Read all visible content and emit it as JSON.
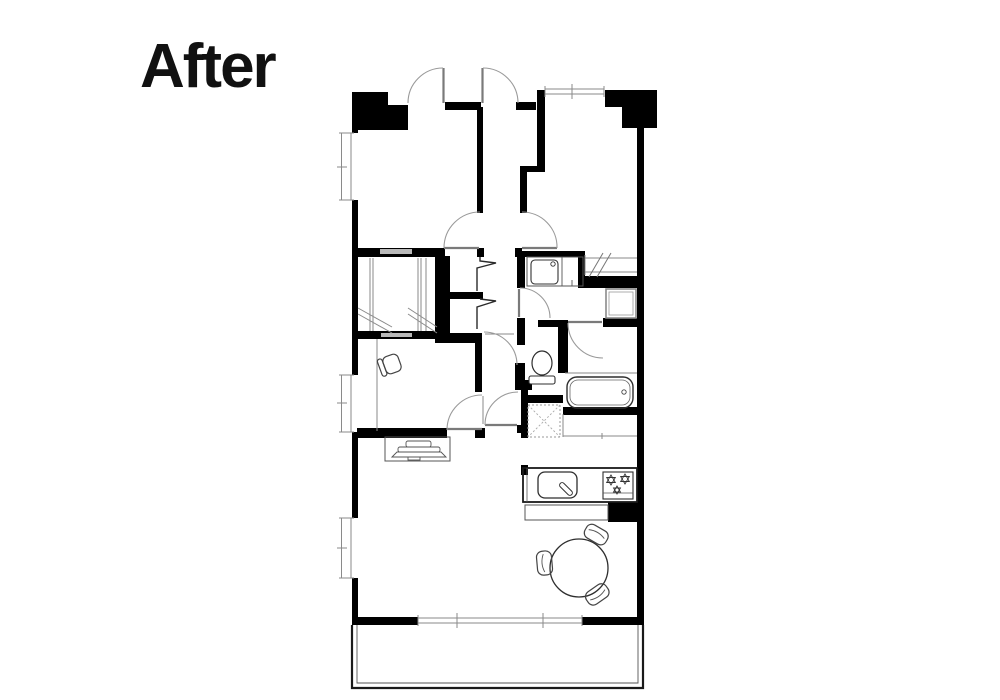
{
  "title": "After",
  "colors": {
    "wall": "#000000",
    "thin": "#8a8a8a",
    "leaf": "#7a7a7a",
    "arc": "#9a9a9a",
    "gap": "#b9b9b9",
    "zigzag": "#2b2b2b",
    "background": "#ffffff"
  },
  "plan": {
    "walls": [
      [
        352,
        92,
        36,
        38
      ],
      [
        388,
        105,
        20,
        25
      ],
      [
        445,
        102,
        36,
        8
      ],
      [
        516,
        102,
        20,
        8
      ],
      [
        537,
        90,
        8,
        78
      ],
      [
        605,
        90,
        17,
        17
      ],
      [
        622,
        90,
        35,
        38
      ],
      [
        637,
        128,
        7,
        497
      ],
      [
        352,
        92,
        6,
        41
      ],
      [
        352,
        200,
        6,
        175
      ],
      [
        352,
        432,
        6,
        86
      ],
      [
        352,
        578,
        6,
        47
      ],
      [
        352,
        617,
        66,
        8
      ],
      [
        582,
        617,
        62,
        8
      ],
      [
        357,
        248,
        88,
        9
      ],
      [
        477,
        248,
        7,
        9
      ],
      [
        477,
        107,
        6,
        106
      ],
      [
        520,
        166,
        25,
        6
      ],
      [
        520,
        172,
        7,
        41
      ],
      [
        515,
        248,
        7,
        9
      ],
      [
        522,
        251,
        63,
        6
      ],
      [
        517,
        257,
        8,
        31
      ],
      [
        578,
        255,
        7,
        33
      ],
      [
        585,
        276,
        52,
        12
      ],
      [
        517,
        318,
        8,
        27
      ],
      [
        538,
        320,
        24,
        7
      ],
      [
        603,
        318,
        34,
        9
      ],
      [
        558,
        320,
        10,
        53
      ],
      [
        515,
        363,
        10,
        17
      ],
      [
        515,
        380,
        17,
        10
      ],
      [
        521,
        390,
        7,
        48
      ],
      [
        528,
        395,
        35,
        8
      ],
      [
        563,
        407,
        74,
        8
      ],
      [
        475,
        333,
        7,
        59
      ],
      [
        475,
        428,
        10,
        10
      ],
      [
        517,
        425,
        8,
        8
      ],
      [
        435,
        256,
        15,
        87
      ],
      [
        450,
        333,
        28,
        10
      ],
      [
        448,
        292,
        35,
        7
      ],
      [
        357,
        331,
        90,
        8
      ],
      [
        357,
        428,
        90,
        10
      ],
      [
        521,
        465,
        7,
        10
      ],
      [
        608,
        502,
        32,
        20
      ]
    ],
    "gray_gaps": [
      [
        380,
        249,
        32,
        5
      ],
      [
        381,
        333,
        31,
        4
      ]
    ],
    "thin_lines": [
      [
        565,
        373,
        637,
        373
      ],
      [
        563,
        414,
        563,
        437
      ],
      [
        563,
        436,
        637,
        436
      ],
      [
        602,
        433,
        602,
        439
      ],
      [
        485,
        334,
        514,
        334
      ],
      [
        483,
        396,
        483,
        424
      ],
      [
        377,
        339,
        377,
        431
      ],
      [
        370,
        258,
        370,
        331
      ],
      [
        373,
        258,
        373,
        331
      ],
      [
        418,
        258,
        418,
        331
      ],
      [
        421,
        258,
        421,
        331
      ],
      [
        426,
        258,
        426,
        331
      ],
      [
        358,
        308,
        392,
        327
      ],
      [
        358,
        314,
        392,
        333
      ],
      [
        408,
        308,
        437,
        327
      ],
      [
        408,
        314,
        437,
        333
      ]
    ],
    "door_leaves": [
      [
        443.5,
        68,
        443.5,
        103
      ],
      [
        482.5,
        68,
        482.5,
        103
      ],
      [
        444,
        248,
        479,
        248
      ],
      [
        522,
        248,
        557,
        248
      ],
      [
        519,
        289,
        519,
        317
      ],
      [
        447,
        429,
        482,
        429
      ],
      [
        485,
        425,
        517,
        425
      ],
      [
        568,
        322,
        602,
        322
      ]
    ],
    "door_arcs": [
      "M408,103 A35,35 0 0 1 443,68",
      "M483,68 A35,35 0 0 1 518,103",
      "M480,212 A36,36 0 0 0 444,248",
      "M522,212 A35,35 0 0 1 557,248",
      "M520,288 A30,30 0 0 1 550,318",
      "M484,332 A33,33 0 0 1 517,365",
      "M482,395 A35,35 0 0 0 447,430",
      "M485,425 A33,33 0 0 1 518,392",
      "M568,323 A35,35 0 0 0 603,358"
    ],
    "zigzag_doors": [
      [
        480,
        257,
        480,
        261,
        496,
        263,
        477,
        268,
        477,
        291
      ],
      [
        480,
        299,
        496,
        301,
        477,
        307,
        477,
        329
      ]
    ],
    "windows": [
      {
        "o": "v",
        "x": 340,
        "y": 133,
        "len": 67,
        "ticks": [
          167
        ]
      },
      {
        "o": "v",
        "x": 340,
        "y": 375,
        "len": 57,
        "ticks": [
          403
        ]
      },
      {
        "o": "v",
        "x": 340,
        "y": 518,
        "len": 60,
        "ticks": [
          548
        ]
      },
      {
        "o": "h",
        "x": 545,
        "y": 88,
        "len": 59,
        "ticks": [
          572
        ]
      },
      {
        "o": "h",
        "x": 418,
        "y": 617,
        "len": 164,
        "ticks": [
          457,
          543
        ]
      }
    ],
    "fixtures": [
      {
        "name": "bathtub",
        "items": [
          {
            "t": "rect",
            "x": 567,
            "y": 377,
            "w": 66,
            "h": 31,
            "rx": 10,
            "sw": 1.4,
            "st": "#2e2e2e"
          },
          {
            "t": "rect",
            "x": 570,
            "y": 380,
            "w": 60,
            "h": 25,
            "rx": 8,
            "sw": 0.8,
            "st": "#666666"
          },
          {
            "t": "circle",
            "cx": 624,
            "cy": 392,
            "r": 2.2,
            "sw": 0.9,
            "st": "#444444"
          }
        ]
      },
      {
        "name": "toilet",
        "items": [
          {
            "t": "ellipse",
            "cx": 542,
            "cy": 363,
            "rx": 10,
            "ry": 12,
            "sw": 1.2,
            "st": "#2e2e2e"
          },
          {
            "t": "rect",
            "x": 529,
            "y": 376,
            "w": 26,
            "h": 8,
            "rx": 2,
            "sw": 1.1,
            "st": "#2e2e2e",
            "f": "#ffffff"
          }
        ]
      },
      {
        "name": "vanity-basin",
        "items": [
          {
            "t": "rect",
            "x": 527,
            "y": 257,
            "w": 56,
            "h": 29,
            "sw": 1,
            "st": "#555555"
          },
          {
            "t": "line",
            "x1": 562,
            "y1": 257,
            "x2": 562,
            "y2": 286,
            "sw": 0.9,
            "st": "#555555"
          },
          {
            "t": "rect",
            "x": 531,
            "y": 260,
            "w": 27,
            "h": 24,
            "rx": 4,
            "sw": 1.1,
            "st": "#333333"
          },
          {
            "t": "circle",
            "cx": 553,
            "cy": 264,
            "r": 2.2,
            "sw": 0.9,
            "st": "#333333"
          },
          {
            "t": "line",
            "x1": 572,
            "y1": 280,
            "x2": 572,
            "y2": 286,
            "sw": 0.9,
            "st": "#555555"
          }
        ]
      },
      {
        "name": "pipe-space-box",
        "items": [
          {
            "t": "rect",
            "x": 606,
            "y": 289,
            "w": 30,
            "h": 29,
            "sw": 1.6,
            "st": "#8a8a8a"
          },
          {
            "t": "rect",
            "x": 609,
            "y": 292,
            "w": 24,
            "h": 23,
            "sw": 0.8,
            "st": "#9a9a9a"
          }
        ]
      },
      {
        "name": "interior-window-slashed",
        "items": [
          {
            "t": "line",
            "x1": 585,
            "y1": 258,
            "x2": 637,
            "y2": 258,
            "sw": 1,
            "st": "#8a8a8a"
          },
          {
            "t": "line",
            "x1": 585,
            "y1": 272,
            "x2": 637,
            "y2": 272,
            "sw": 1,
            "st": "#8a8a8a"
          },
          {
            "t": "line",
            "x1": 585,
            "y1": 255,
            "x2": 585,
            "y2": 275,
            "sw": 1,
            "st": "#8a8a8a"
          },
          {
            "t": "line",
            "x1": 589,
            "y1": 277,
            "x2": 603,
            "y2": 253,
            "sw": 1,
            "st": "#777777"
          },
          {
            "t": "line",
            "x1": 597,
            "y1": 277,
            "x2": 611,
            "y2": 253,
            "sw": 1,
            "st": "#777777"
          }
        ]
      },
      {
        "name": "washing-machine-space",
        "items": [
          {
            "t": "rect",
            "x": 528,
            "y": 405,
            "w": 32,
            "h": 32,
            "sw": 1,
            "st": "#999999",
            "dash": 1
          },
          {
            "t": "line",
            "x1": 528,
            "y1": 405,
            "x2": 560,
            "y2": 437,
            "sw": 0.9,
            "st": "#aaaaaa",
            "dash": 1
          },
          {
            "t": "line",
            "x1": 560,
            "y1": 405,
            "x2": 528,
            "y2": 437,
            "sw": 0.9,
            "st": "#aaaaaa",
            "dash": 1
          }
        ]
      },
      {
        "name": "kitchen-counter",
        "items": [
          {
            "t": "rect",
            "x": 523,
            "y": 468,
            "w": 114,
            "h": 34,
            "sw": 1.8,
            "st": "#1a1a1a"
          },
          {
            "t": "line",
            "x1": 527,
            "y1": 468,
            "x2": 527,
            "y2": 502,
            "sw": 0.8,
            "st": "#555555"
          }
        ]
      },
      {
        "name": "kitchen-sink",
        "items": [
          {
            "t": "rect",
            "x": 538,
            "y": 472,
            "w": 39,
            "h": 26,
            "rx": 7,
            "sw": 1.3,
            "st": "#2e2e2e"
          },
          {
            "t": "g",
            "tf": "translate(566,489) rotate(-45)",
            "items": [
              {
                "t": "rect",
                "x": -2.5,
                "y": -8,
                "w": 5,
                "h": 16,
                "rx": 2.5,
                "sw": 1,
                "st": "#333333",
                "f": "#ffffff"
              }
            ]
          }
        ]
      },
      {
        "name": "gas-stove",
        "items": [
          {
            "t": "rect",
            "x": 603,
            "y": 472,
            "w": 30,
            "h": 27,
            "sw": 1.1,
            "st": "#2e2e2e"
          },
          {
            "t": "line",
            "x1": 603,
            "y1": 493,
            "x2": 633,
            "y2": 493,
            "sw": 0.8,
            "st": "#555555"
          },
          {
            "t": "hex",
            "cx": 611,
            "cy": 480,
            "r": 5
          },
          {
            "t": "hex",
            "cx": 625,
            "cy": 479,
            "r": 5
          },
          {
            "t": "hex",
            "cx": 617,
            "cy": 490,
            "r": 4
          }
        ]
      },
      {
        "name": "counter-front",
        "items": [
          {
            "t": "rect",
            "x": 525,
            "y": 505,
            "w": 83,
            "h": 15,
            "sw": 1,
            "st": "#555555"
          }
        ]
      },
      {
        "name": "tv-board",
        "items": [
          {
            "t": "rect",
            "x": 385,
            "y": 437,
            "w": 65,
            "h": 24,
            "sw": 1,
            "st": "#555555"
          },
          {
            "t": "rect",
            "x": 406,
            "y": 441,
            "w": 25,
            "h": 6,
            "rx": 2,
            "sw": 0.9,
            "st": "#555555"
          },
          {
            "t": "rect",
            "x": 398,
            "y": 447,
            "w": 42,
            "h": 5,
            "rx": 2,
            "sw": 0.9,
            "st": "#555555"
          },
          {
            "t": "path",
            "d": "M392,457 L397,452 L441,452 L446,457 Z",
            "sw": 0.9,
            "st": "#555555"
          },
          {
            "t": "rect",
            "x": 408,
            "y": 457,
            "w": 12,
            "h": 3,
            "sw": 0.9,
            "st": "#555555"
          }
        ]
      },
      {
        "name": "desk-chair",
        "items": [
          {
            "t": "g",
            "tf": "translate(392,364) rotate(-20)",
            "items": [
              {
                "t": "rect",
                "x": -8,
                "y": -9,
                "w": 16,
                "h": 18,
                "rx": 5,
                "sw": 1.2,
                "st": "#444444"
              },
              {
                "t": "rect",
                "x": -13,
                "y": -9,
                "w": 5,
                "h": 18,
                "rx": 2.5,
                "sw": 1.2,
                "st": "#444444"
              }
            ]
          }
        ]
      },
      {
        "name": "dining-table",
        "items": [
          {
            "t": "circle",
            "cx": 579,
            "cy": 568,
            "r": 29,
            "sw": 1.3,
            "st": "#2e2e2e"
          }
        ]
      },
      {
        "name": "dining-chair",
        "items": [
          {
            "t": "g",
            "tf": "translate(596,535) rotate(30)",
            "items": [
              {
                "t": "rect",
                "x": -12,
                "y": -8,
                "w": 24,
                "h": 15,
                "rx": 6,
                "sw": 1.2,
                "st": "#444444"
              },
              {
                "t": "path",
                "d": "M-9,-1 Q0,-5 9,-1",
                "sw": 0.9,
                "st": "#555555"
              }
            ]
          }
        ]
      },
      {
        "name": "dining-chair",
        "items": [
          {
            "t": "g",
            "tf": "translate(545,563) rotate(-95)",
            "items": [
              {
                "t": "rect",
                "x": -12,
                "y": -8,
                "w": 24,
                "h": 15,
                "rx": 6,
                "sw": 1.2,
                "st": "#444444"
              },
              {
                "t": "path",
                "d": "M-9,-1 Q0,-5 9,-1",
                "sw": 0.9,
                "st": "#555555"
              }
            ]
          }
        ]
      },
      {
        "name": "dining-chair",
        "items": [
          {
            "t": "g",
            "tf": "translate(597,594) rotate(145)",
            "items": [
              {
                "t": "rect",
                "x": -12,
                "y": -8,
                "w": 24,
                "h": 15,
                "rx": 6,
                "sw": 1.2,
                "st": "#444444"
              },
              {
                "t": "path",
                "d": "M-9,-1 Q0,-5 9,-1",
                "sw": 0.9,
                "st": "#555555"
              }
            ]
          }
        ]
      },
      {
        "name": "balcony",
        "items": [
          {
            "t": "path",
            "d": "M352,625 L352,688 L643,688 L643,625",
            "sw": 2.2,
            "st": "#1a1a1a"
          },
          {
            "t": "path",
            "d": "M357,625 L357,683 L638,683 L638,625",
            "sw": 0.9,
            "st": "#555555"
          }
        ]
      }
    ]
  }
}
